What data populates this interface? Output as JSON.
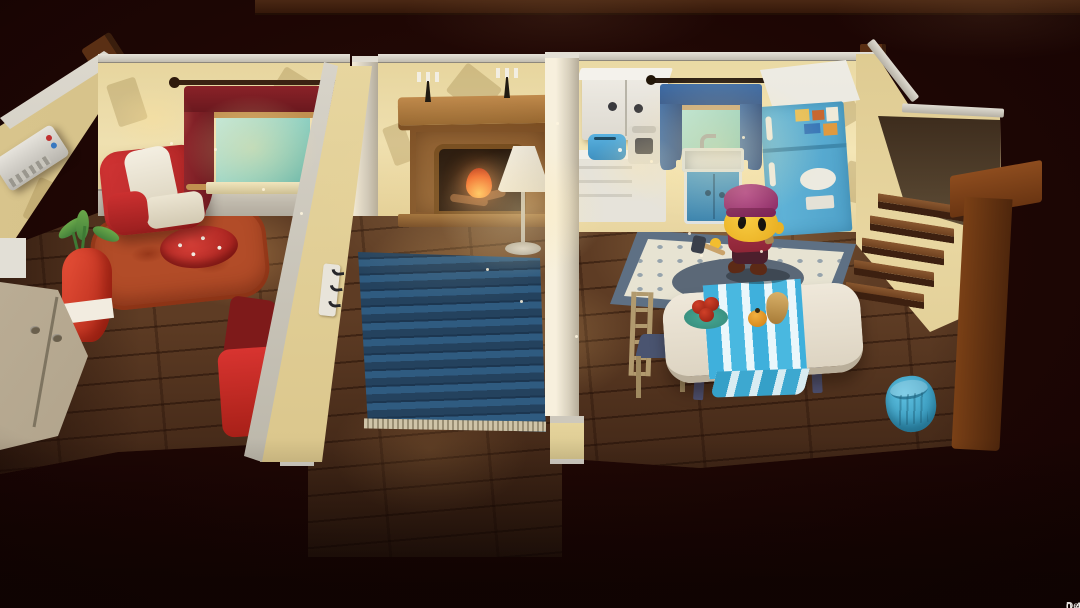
{
  "hud": {
    "version": "0.4.8",
    "build_label": "Development Build"
  },
  "palette": {
    "background": "#1d0604",
    "floor_wood": "#5e3c24",
    "wall_cream": "#efe0b0",
    "trim_gray": "#c2bdb1",
    "curtain_red": "#7e2026",
    "curtain_blue": "#3c6ba6",
    "rug_blue": "#2f5b80",
    "rug_orange": "#b24c28",
    "rug_kitchen_border": "#5e7084",
    "fridge_blue": "#5fb6dc",
    "table_runner_blue": "#3fb0dc",
    "armchair_red": "#d23434",
    "character_hat_purple": "#993070",
    "character_skin_yellow": "#f2bd2f",
    "character_shirt_red": "#8e2636",
    "fire_orange": "#f06020",
    "version_text": "#ece8e4"
  }
}
